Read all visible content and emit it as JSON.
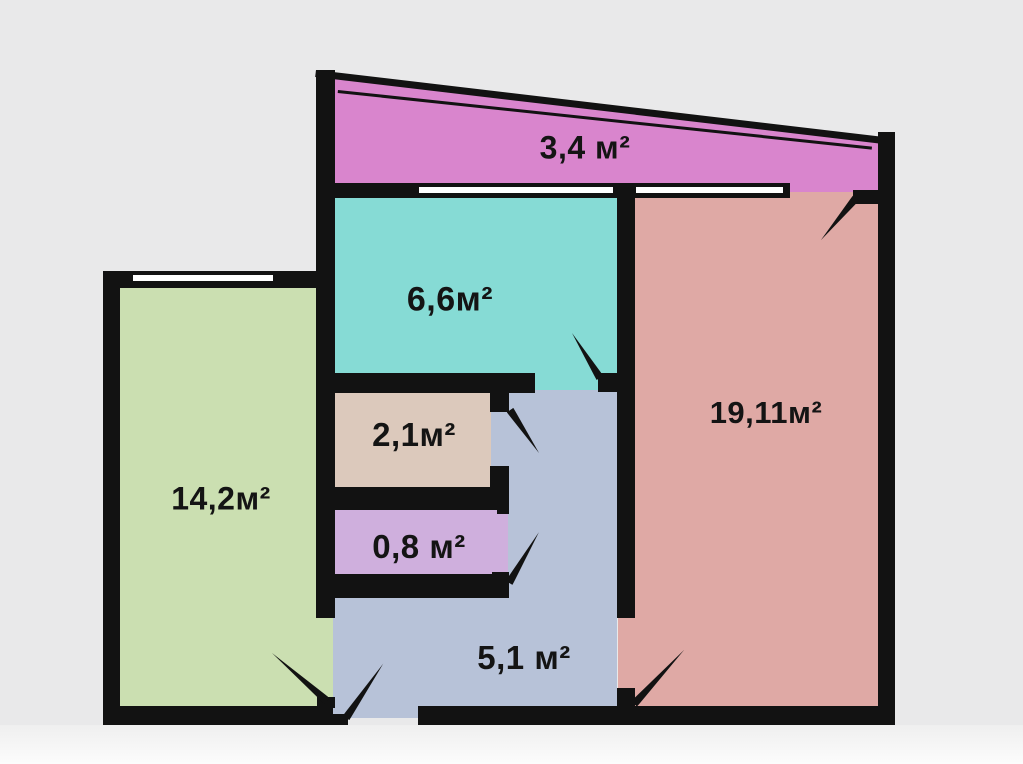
{
  "plan": {
    "type": "apartment-floor-plan",
    "unit": "м²"
  },
  "colors": {
    "wall": "#121212",
    "window": "#ffffff",
    "background": "#e9e9ea",
    "label_text": "#141414"
  },
  "rooms": [
    {
      "id": "balcony",
      "area": "3,4 м²",
      "color": "#d985cd"
    },
    {
      "id": "kitchen",
      "area": "6,6м²",
      "color": "#86dbd5"
    },
    {
      "id": "living-room",
      "area": "19,11м²",
      "color": "#dfa9a5"
    },
    {
      "id": "bedroom",
      "area": "14,2м²",
      "color": "#cbdfb1"
    },
    {
      "id": "storage",
      "area": "2,1м²",
      "color": "#dcc9bc"
    },
    {
      "id": "wc",
      "area": "0,8 м²",
      "color": "#cfafdd"
    },
    {
      "id": "hallway",
      "area": "5,1 м²",
      "color": "#b7c2d8"
    }
  ]
}
